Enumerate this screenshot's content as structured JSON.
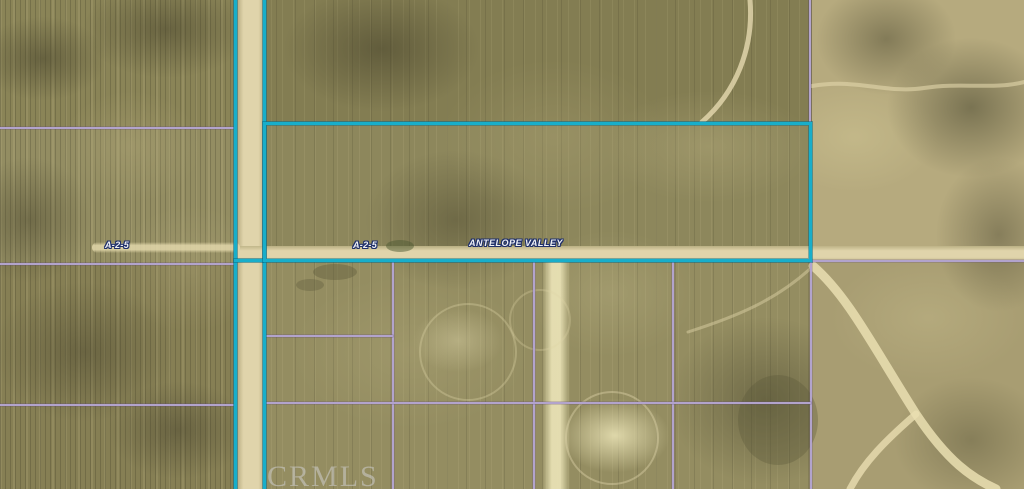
{
  "canvas": {
    "width_px": 1024,
    "height_px": 489
  },
  "map": {
    "kind": "aerial-parcel-map",
    "watermark": "CRMLS",
    "road_label": "ANTELOPE VALLEY",
    "zoning_labels": [
      {
        "text": "A-2-5",
        "area": "west-field"
      },
      {
        "text": "A-2-5",
        "area": "subject-parcel"
      }
    ],
    "colors": {
      "subject_parcel_outline": "#18aeca",
      "parcel_grid_lines": "#b2a3cc",
      "road_surface": "#e0d4ab",
      "terrain_olive": "#87814f",
      "terrain_sand": "#b2a67b",
      "label_text_fill": "#eef0f5",
      "label_text_outline": "#20306a",
      "watermark_color": "#cdcdcd"
    }
  }
}
